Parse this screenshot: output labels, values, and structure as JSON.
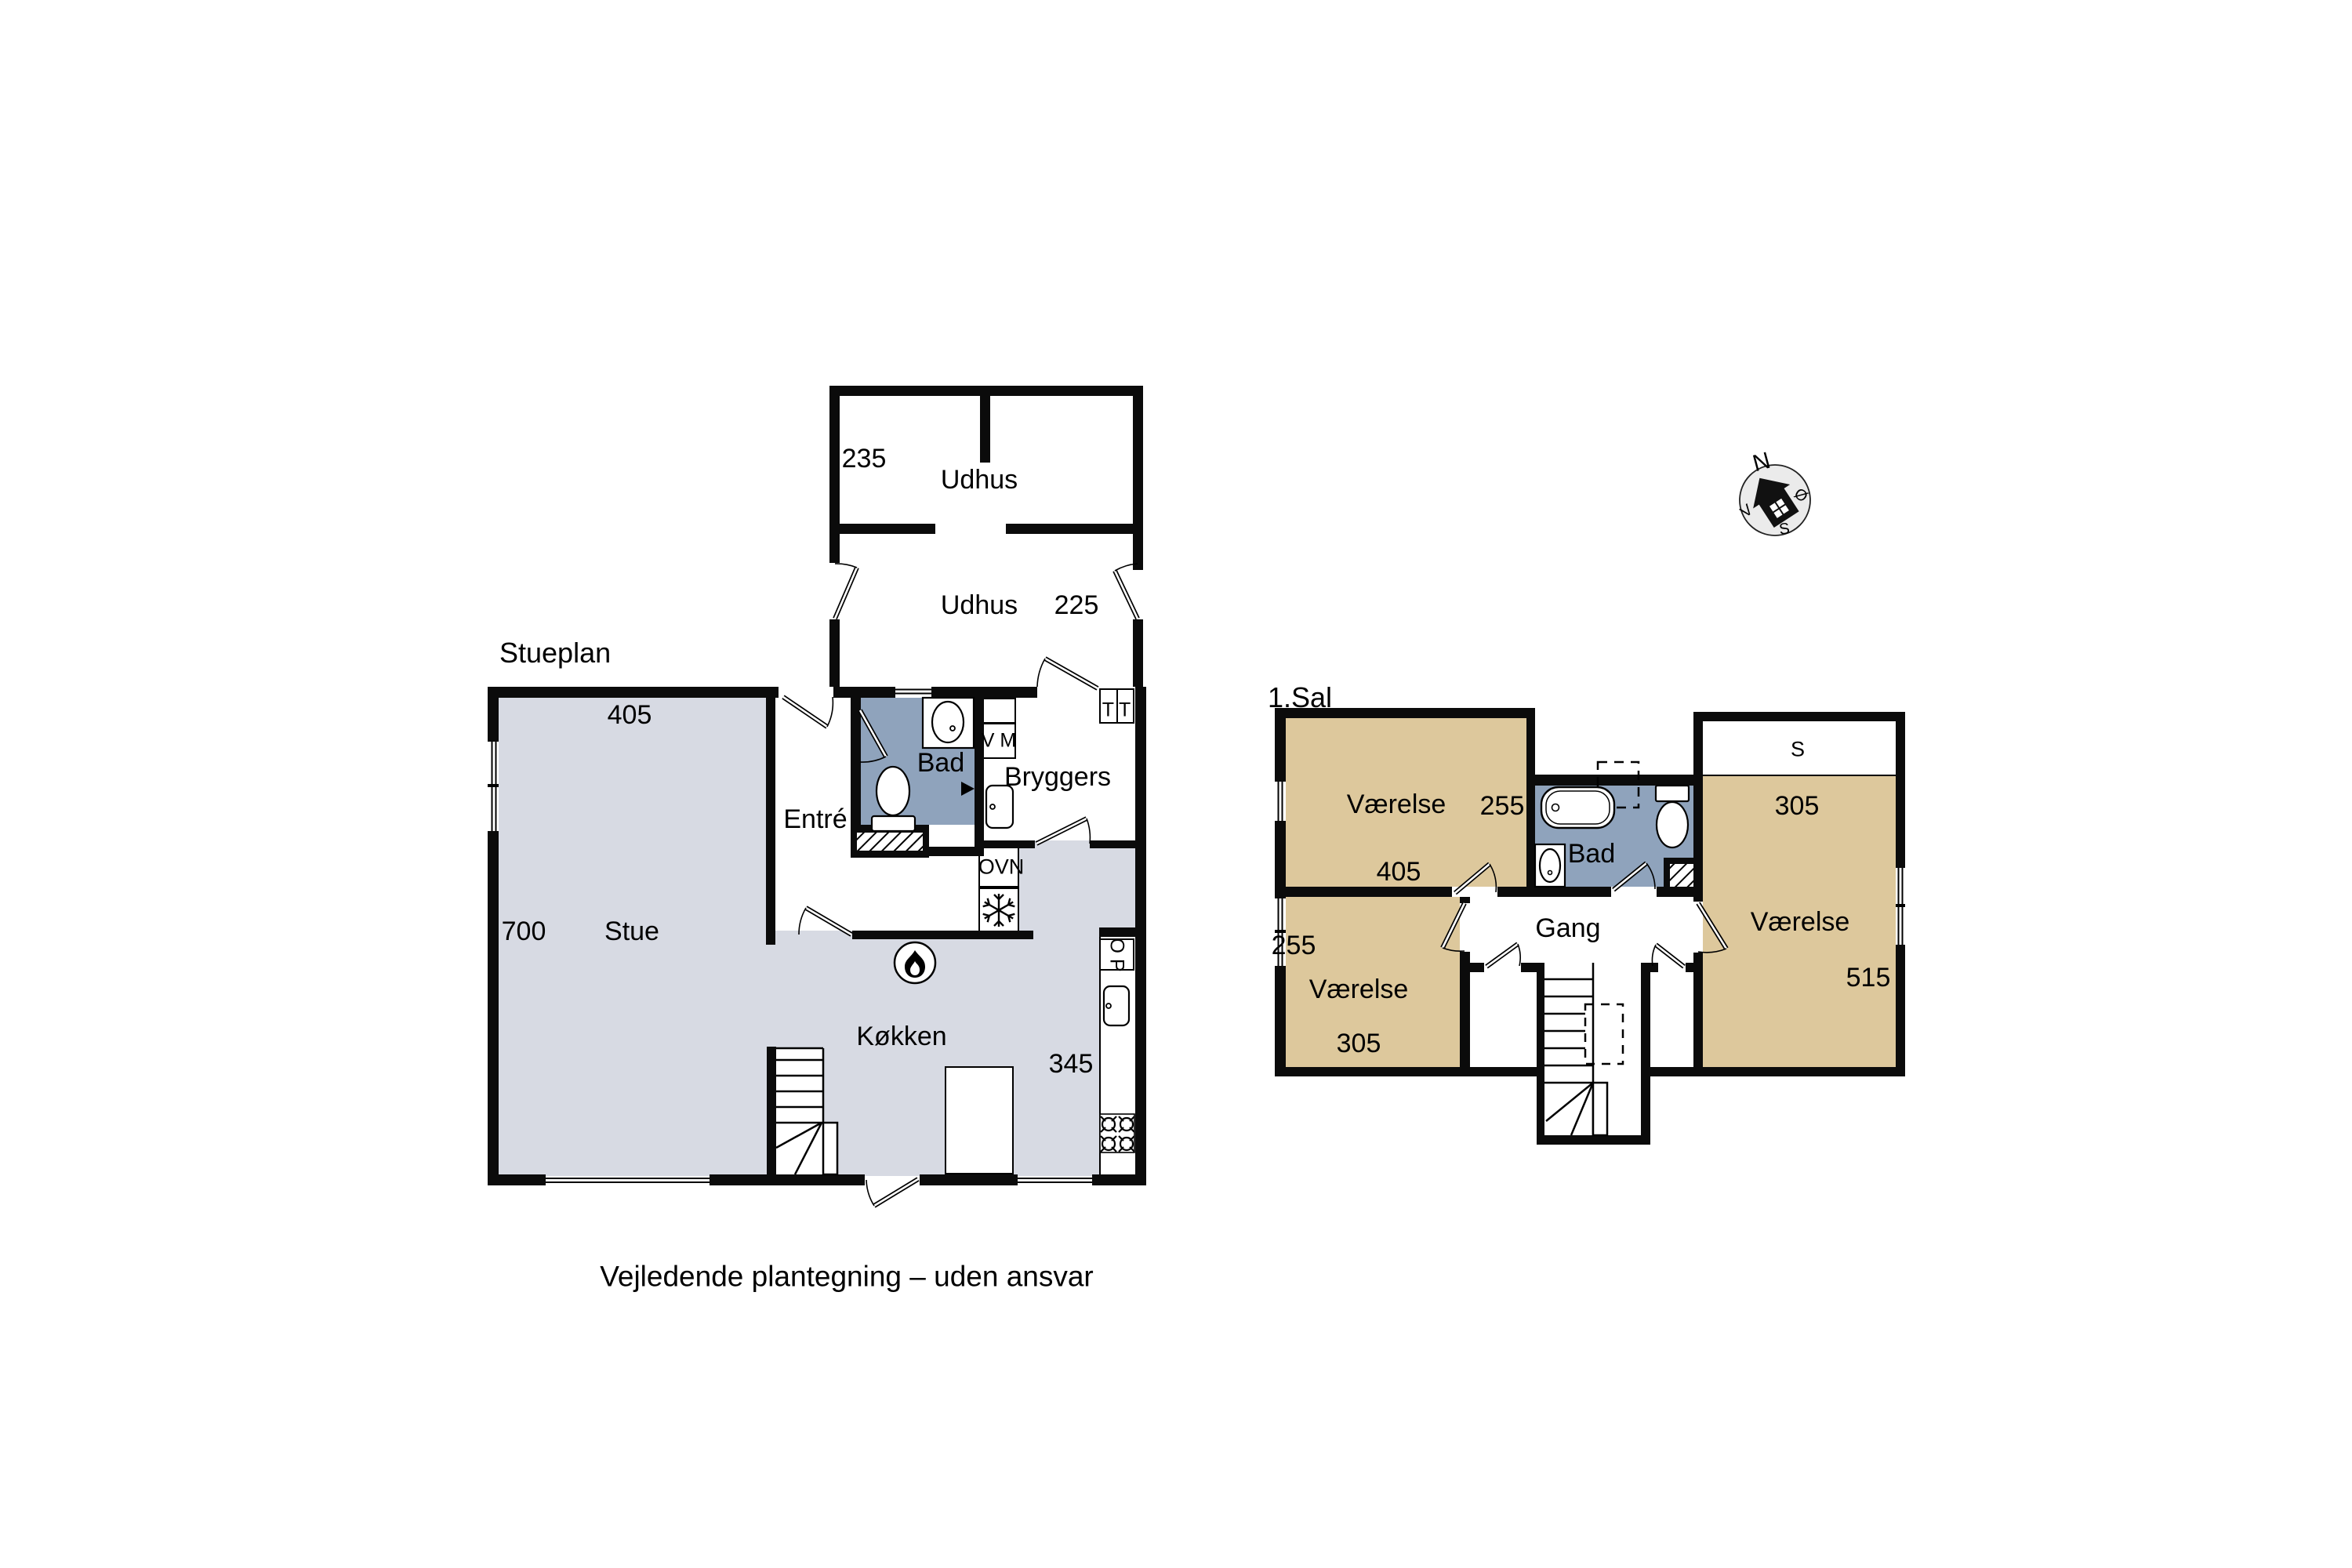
{
  "note": "Vejledende plantegning – uden ansvar",
  "compass": {
    "north": "N",
    "east": "Ø",
    "south": "S",
    "west": "V"
  },
  "ground": {
    "title": "Stueplan",
    "stue": {
      "name": "Stue",
      "width": "405",
      "depth": "700"
    },
    "entre": {
      "name": "Entré"
    },
    "bad": {
      "name": "Bad"
    },
    "bryggers": {
      "name": "Bryggers"
    },
    "kokken": {
      "name": "Køkken",
      "width": "345"
    },
    "appliances": {
      "washer": "V M",
      "dryer": "T T",
      "oven": "OVN",
      "dishwasher": "O P"
    },
    "udhus_upper": {
      "name": "Udhus",
      "width": "235"
    },
    "udhus_lower": {
      "name": "Udhus",
      "width": "225"
    }
  },
  "first": {
    "title": "1.Sal",
    "room_nw": {
      "name": "Værelse",
      "depth": "255",
      "width": "405"
    },
    "room_sw": {
      "name": "Værelse",
      "depth": "255",
      "width": "305"
    },
    "room_e": {
      "name": "Værelse",
      "width": "305",
      "depth": "515",
      "sloped": "S"
    },
    "bad": {
      "name": "Bad"
    },
    "gang": {
      "name": "Gang"
    }
  },
  "colors": {
    "room_gray": "#d7dae3",
    "bad_blue": "#8fa3bc",
    "room_tan": "#ddc89c",
    "wall": "#0b0b0b"
  }
}
